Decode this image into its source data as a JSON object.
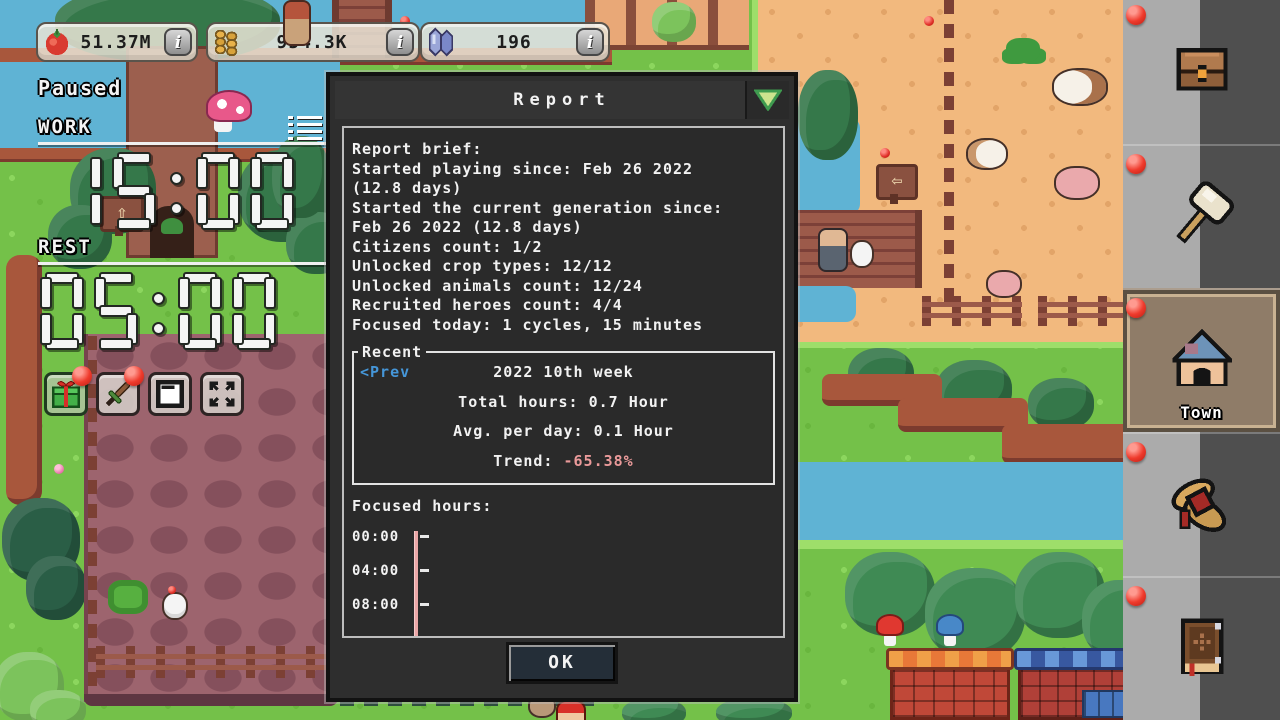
{
  "hud": {
    "status": "Paused",
    "resources": [
      {
        "name": "tomatoes",
        "icon": "tomato-icon",
        "value": "51.37M",
        "info": "i"
      },
      {
        "name": "coins",
        "icon": "coins-icon",
        "value": "954.3K",
        "info": "i"
      },
      {
        "name": "gems",
        "icon": "crystals-icon",
        "value": "196",
        "info": "i"
      }
    ],
    "timers": {
      "work_label": "WORK",
      "work_time": "15:00",
      "rest_label": "REST",
      "rest_time": "05:00",
      "menu_icon": "task-list-icon"
    }
  },
  "quick_buttons": [
    {
      "icon": "gift-icon",
      "notification": true
    },
    {
      "icon": "sword-icon",
      "notification": true
    },
    {
      "icon": "window-icon",
      "notification": false
    },
    {
      "icon": "fullscreen-icon",
      "notification": false
    }
  ],
  "dialog": {
    "title": "Report",
    "collapse_icon": "triangle-down-icon",
    "brief": [
      "Report brief:",
      "Started playing since: Feb 26 2022",
      "(12.8 days)",
      "Started the current generation since:",
      "Feb 26 2022 (12.8 days)",
      "Citizens count: 1/2",
      "Unlocked crop types: 12/12",
      "Unlocked animals count: 12/24",
      "Recruited heroes count: 4/4",
      "Focused today: 1 cycles, 15 minutes"
    ],
    "recent": {
      "legend": "Recent",
      "prev": "<Prev",
      "week": "2022 10th week",
      "stats": [
        {
          "label": "Total hours:",
          "value": "0.7 Hour"
        },
        {
          "label": "Avg. per day:",
          "value": "0.1 Hour"
        },
        {
          "label": "Trend:",
          "value": "-65.38%"
        }
      ]
    },
    "chart": {
      "label": "Focused hours:",
      "y_ticks": [
        "00:00",
        "04:00",
        "08:00"
      ],
      "axis_color": "#eaa6a6"
    },
    "ok": "OK"
  },
  "sidebar": {
    "items": [
      {
        "icon": "chest-icon",
        "label": "",
        "notification": true,
        "selected": false
      },
      {
        "icon": "hammer-icon",
        "label": "",
        "notification": true,
        "selected": false
      },
      {
        "icon": "town-icon",
        "label": "Town",
        "notification": true,
        "selected": true
      },
      {
        "icon": "bundle-icon",
        "label": "",
        "notification": true,
        "selected": false
      },
      {
        "icon": "book-icon",
        "label": "",
        "notification": true,
        "selected": false
      }
    ]
  },
  "colors": {
    "accent_green": "#cde48e",
    "trend_negative": "#ea9a9a",
    "link_blue": "#4596d8",
    "notification_red": "#e03028"
  }
}
